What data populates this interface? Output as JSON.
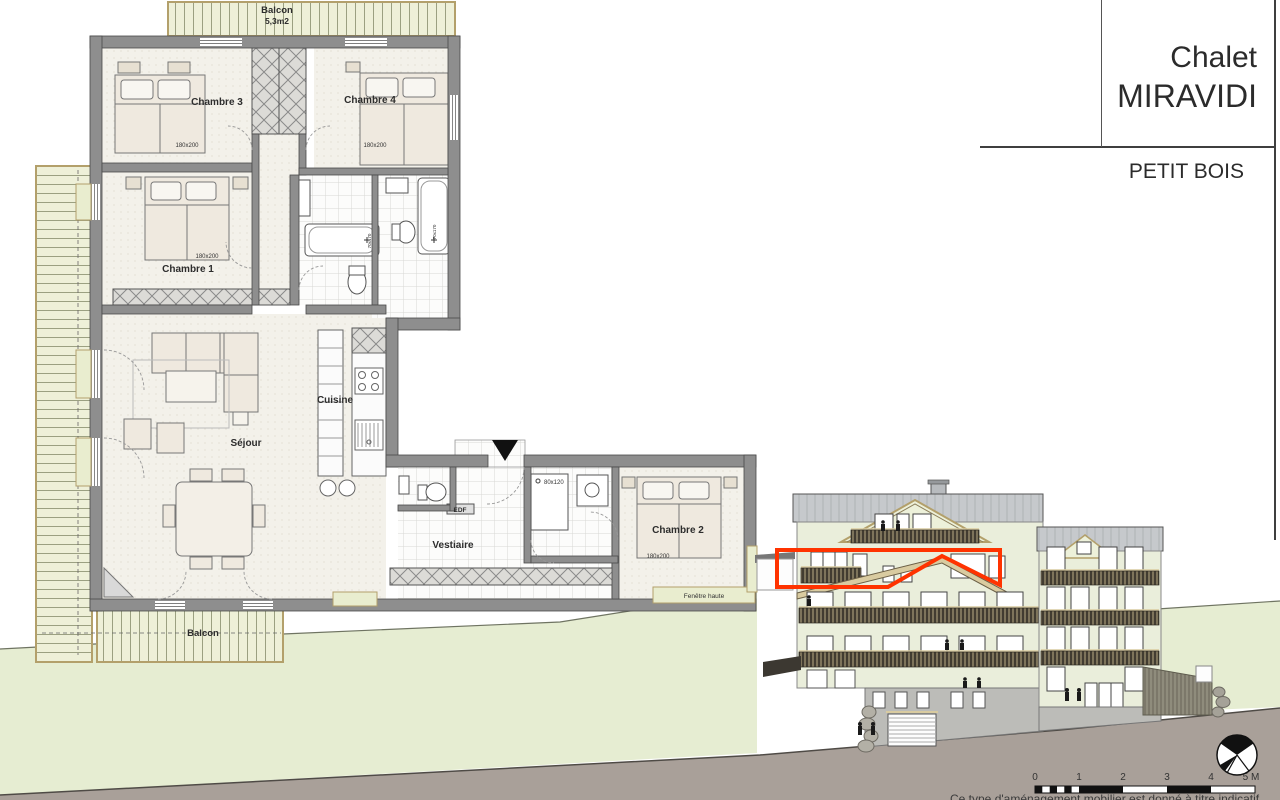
{
  "title_block": {
    "project": "Chalet",
    "name": "MIRAVIDI",
    "subtitle": "PETIT BOIS"
  },
  "floor_plan": {
    "balcony_top": {
      "name": "Balcon",
      "area": "5,3m2"
    },
    "balcony_bottom": {
      "name": "Balcon"
    },
    "chambre1": {
      "name": "Chambre 1",
      "bed_size": "180x200"
    },
    "chambre2": {
      "name": "Chambre 2",
      "bed_size": "180x200"
    },
    "chambre3": {
      "name": "Chambre 3",
      "bed_size": "180x200"
    },
    "chambre4": {
      "name": "Chambre 4",
      "bed_size": "180x200"
    },
    "sejour": {
      "name": "Séjour"
    },
    "cuisine": {
      "name": "Cuisine"
    },
    "vestiaire": {
      "name": "Vestiaire"
    },
    "shower_size": "80x120",
    "tub_size": "70x170",
    "edf_label": "EDF",
    "high_window_label": "Fenêtre haute"
  },
  "elevation": {
    "highlight_color": "#ff3300",
    "scale_ticks": [
      "0",
      "1",
      "2",
      "3",
      "4",
      "5 M"
    ]
  },
  "footer": {
    "caption": "Ce type d'aménagement mobilier est donné à titre indicatif"
  }
}
